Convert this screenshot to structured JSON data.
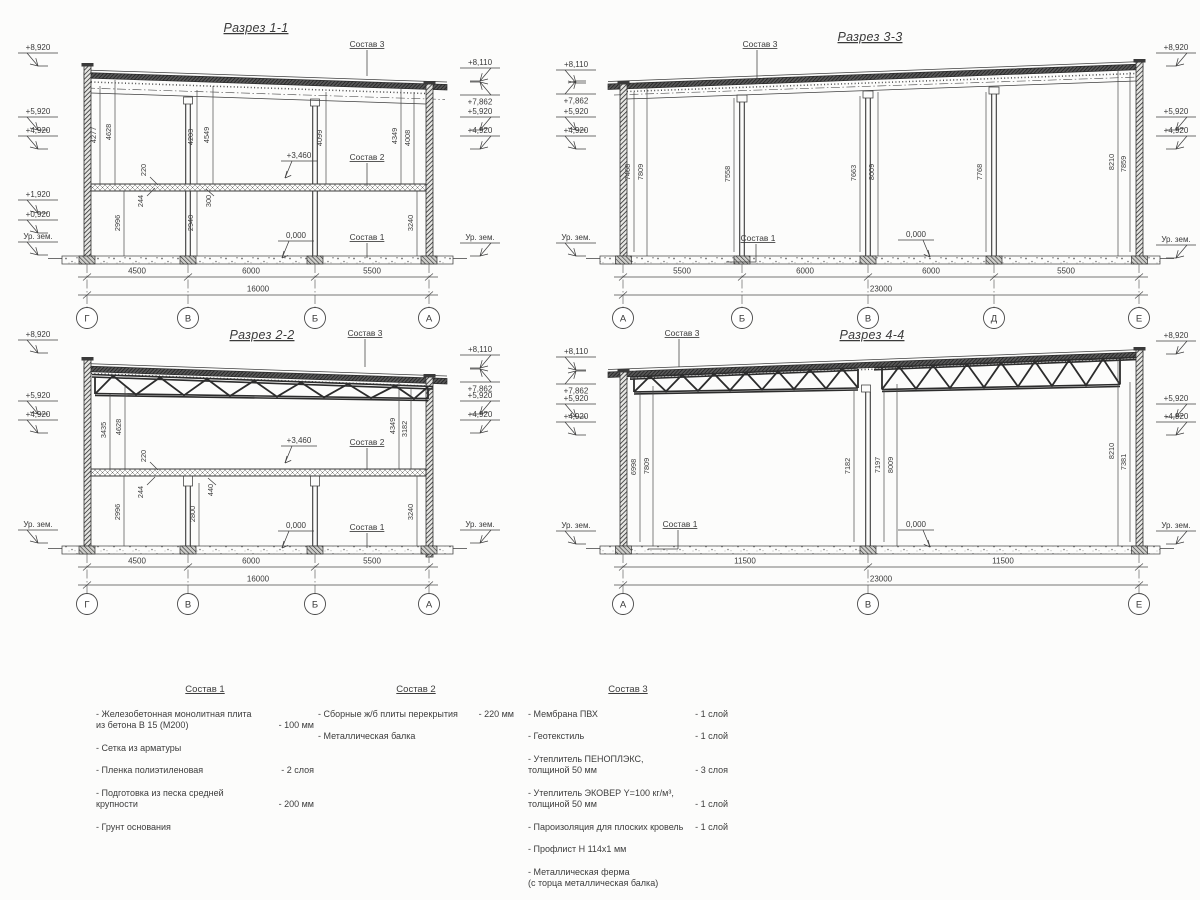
{
  "s1": {
    "title": "Разрез 1-1",
    "elevL": [
      "+8,920",
      "+5,920",
      "+4,920",
      "+1,920",
      "+0,920",
      "Ур. зем."
    ],
    "elevR": [
      "+8,110",
      "+7,862",
      "+5,920",
      "+4,920",
      "Ур. зем."
    ],
    "sostav3": "Состав 3",
    "sostav2": "Состав 2",
    "sostav1": "Состав 1",
    "lvl_floor": "+3,460",
    "lvl_zero": "0,000",
    "vd": [
      "4277",
      "4628",
      "220",
      "244",
      "2996",
      "4203",
      "4549",
      "2940",
      "300",
      "4099",
      "4349",
      "4008",
      "3240"
    ],
    "spans": [
      "4500",
      "6000",
      "5500"
    ],
    "total": "16000",
    "grid": [
      "Г",
      "В",
      "Б",
      "А"
    ]
  },
  "s2": {
    "title": "Разрез 2-2",
    "elevL": [
      "+8,920",
      "+5,920",
      "+4,920",
      "Ур. зем."
    ],
    "elevR": [
      "+8,110",
      "+7,862",
      "+5,920",
      "+4,920",
      "Ур. зем."
    ],
    "sostav3": "Состав 3",
    "sostav2": "Состав 2",
    "sostav1": "Состав 1",
    "lvl_floor": "+3,460",
    "lvl_zero": "0,000",
    "vd": [
      "3435",
      "4628",
      "220",
      "244",
      "2996",
      "2800",
      "440",
      "4349",
      "3182",
      "3240"
    ],
    "spans": [
      "4500",
      "6000",
      "5500"
    ],
    "total": "16000",
    "grid": [
      "Г",
      "В",
      "Б",
      "А"
    ]
  },
  "s3": {
    "title": "Разрез 3-3",
    "elevL": [
      "+8,110",
      "+7,862",
      "+5,920",
      "+4,920",
      "Ур. зем."
    ],
    "elevR": [
      "+8,920",
      "+5,920",
      "+4,920",
      "Ур. зем."
    ],
    "sostav3": "Состав 3",
    "sostav1": "Состав 1",
    "lvl_zero": "0,000",
    "vd": [
      "7468",
      "7809",
      "7558",
      "7663",
      "8009",
      "7768",
      "8210",
      "7859"
    ],
    "spans": [
      "5500",
      "6000",
      "6000",
      "5500"
    ],
    "total": "23000",
    "grid": [
      "А",
      "Б",
      "В",
      "Д",
      "Е"
    ]
  },
  "s4": {
    "title": "Разрез 4-4",
    "elevL": [
      "+8,110",
      "+7,862",
      "+5,920",
      "+4,920",
      "Ур. зем."
    ],
    "elevR": [
      "+8,920",
      "+5,920",
      "+4,920",
      "Ур. зем."
    ],
    "sostav3": "Состав 3",
    "sostav1": "Состав 1",
    "lvl_zero": "0,000",
    "vd": [
      "6998",
      "7809",
      "7182",
      "7197",
      "8009",
      "8210",
      "7381"
    ],
    "spans": [
      "11500",
      "11500"
    ],
    "total": "23000",
    "grid": [
      "А",
      "В",
      "Е"
    ]
  },
  "legend": {
    "cols": [
      {
        "h": "Состав 1",
        "items": [
          {
            "n": "- Железобетонная  монолитная плита\nиз бетона В 15 (М200)",
            "v": "- 100 мм"
          },
          {
            "n": "- Сетка из арматуры",
            "v": ""
          },
          {
            "n": "- Пленка полиэтиленовая",
            "v": "- 2 слоя"
          },
          {
            "n": "- Подготовка из песка средней\nкрупности",
            "v": "- 200 мм"
          },
          {
            "n": "- Грунт основания",
            "v": ""
          }
        ]
      },
      {
        "h": "Состав 2",
        "items": [
          {
            "n": "- Сборные ж/б плиты перекрытия",
            "v": "- 220 мм"
          },
          {
            "n": "- Металлическая балка",
            "v": ""
          }
        ]
      },
      {
        "h": "Состав 3",
        "items": [
          {
            "n": "- Мембрана ПВХ",
            "v": "- 1 слой"
          },
          {
            "n": "- Геотекстиль",
            "v": "- 1 слой"
          },
          {
            "n": "- Утеплитель ПЕНОПЛЭКС,\nтолщиной 50 мм",
            "v": "- 3 слоя"
          },
          {
            "n": "- Утеплитель ЭКОВЕР Y=100 кг/м³,\nтолщиной 50 мм",
            "v": "- 1 слой"
          },
          {
            "n": "- Пароизоляция для плоских кровель",
            "v": "- 1 слой"
          },
          {
            "n": "- Профлист Н 114х1 мм",
            "v": ""
          },
          {
            "n": "- Металлическая ферма\n(с торца металлическая балка)",
            "v": ""
          }
        ]
      }
    ]
  }
}
